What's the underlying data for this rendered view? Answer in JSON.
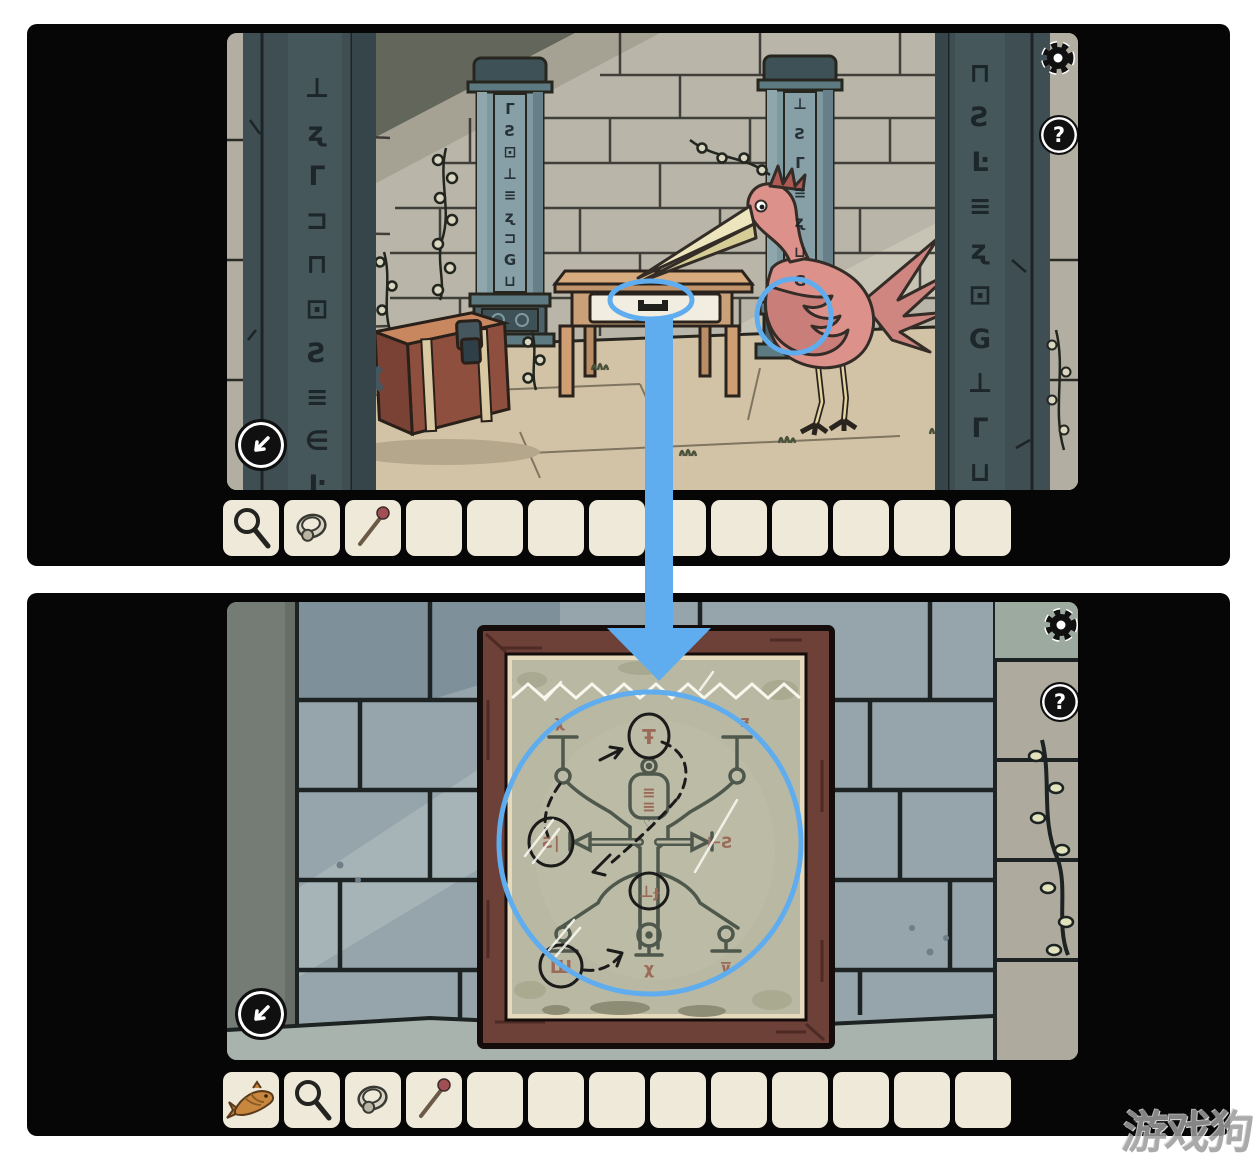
{
  "watermark": {
    "text": "游戏狗"
  },
  "colors": {
    "annotation_blue": "#5fadee",
    "card_black": "#060606",
    "slot_cream": "#efe9da"
  },
  "hud_icons": [
    "settings-gear",
    "help-question",
    "back-arrow-down-left"
  ],
  "top_panel": {
    "buttons": {
      "help": "?"
    },
    "pillars": {
      "left_glyphs": [
        "⊥",
        "ʐ",
        "Γ",
        "⊐",
        "⊓",
        "⊡",
        "Ƨ",
        "≡",
        "∈",
        "Ŀ"
      ],
      "right_glyphs": [
        "⊓",
        "Ƨ",
        "Ŀ",
        "≡",
        "ʐ",
        "⊡",
        "G",
        "⊥",
        "Γ",
        "⊔"
      ]
    },
    "columns": {
      "left_glyphs": [
        "Γ",
        "Ƨ",
        "⊡",
        "⊥",
        "≡",
        "ʐ",
        "⊐",
        "G",
        "⊔"
      ],
      "right_glyphs": [
        "⊥",
        "Ƨ",
        "Γ",
        "≡",
        "ʐ",
        "⊔",
        "G"
      ]
    },
    "inventory": {
      "items": [
        "magnifying-glass",
        "ring",
        "match",
        "",
        "",
        "",
        "",
        "",
        "",
        "",
        "",
        "",
        ""
      ]
    }
  },
  "bottom_panel": {
    "buttons": {
      "help": "?"
    },
    "inventory": {
      "items": [
        "dried-fish",
        "magnifying-glass",
        "ring",
        "match",
        "",
        "",
        "",
        "",
        "",
        "",
        "",
        "",
        ""
      ]
    },
    "diagram": {
      "runes": {
        "top_left": "χ",
        "top_right": "ƶ",
        "head": "Ŧ",
        "torso_upper": "≡",
        "torso_lower": "≡",
        "heart": "♡",
        "mid_left": "Ƨ|",
        "mid_right": "⊢Ƨ",
        "lower_head": "⊥ɟ",
        "bottom_left": "Ш",
        "bottom_center": "χ",
        "bottom_right": "⊽"
      }
    }
  }
}
